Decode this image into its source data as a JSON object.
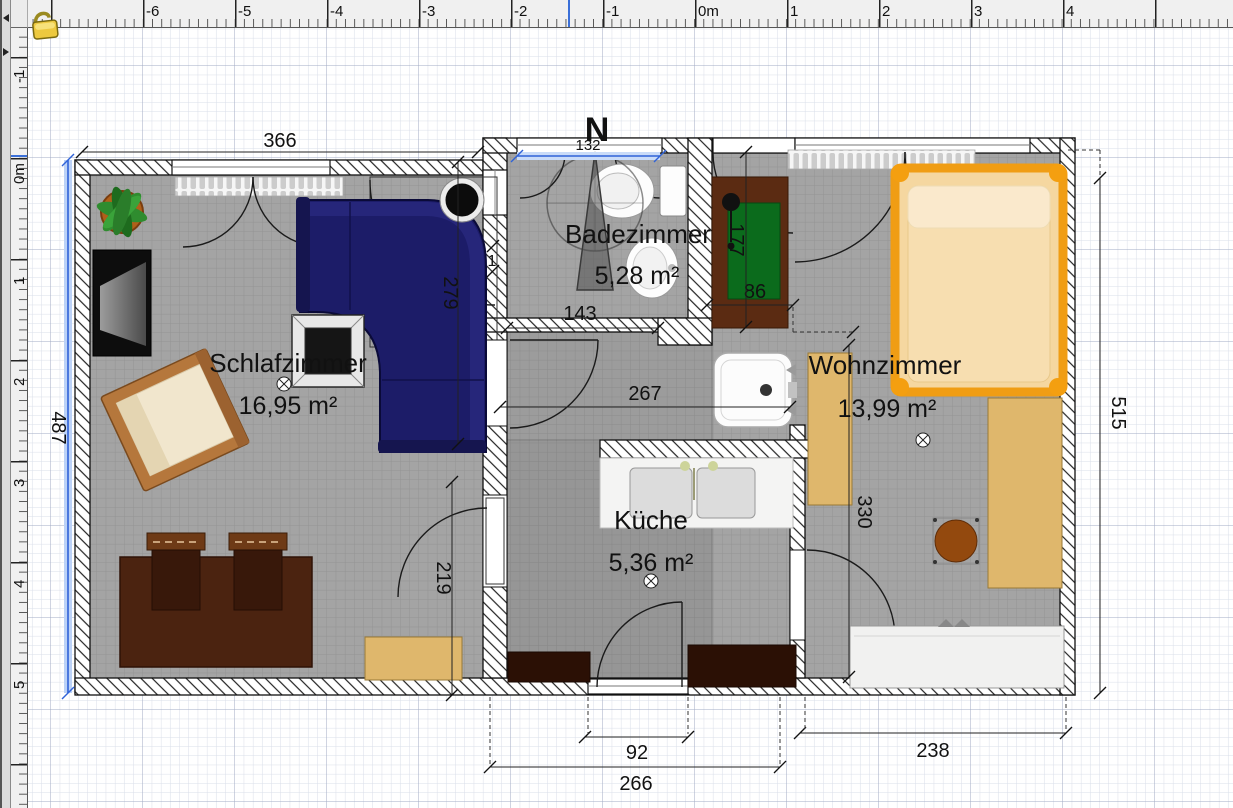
{
  "rulers": {
    "top": {
      "labels": [
        "-6",
        "-5",
        "-4",
        "-3",
        "-2",
        "-1",
        "0m",
        "1",
        "2",
        "3",
        "4"
      ]
    },
    "left": {
      "labels": [
        "-1",
        "0m",
        "1",
        "2",
        "3",
        "4",
        "5"
      ]
    },
    "cursor_color": "#3a6fd8"
  },
  "compass": {
    "label": "N"
  },
  "rooms": [
    {
      "name": "Schlafzimmer",
      "area": "16,95 m²"
    },
    {
      "name": "Badezimmer",
      "area": "5,28 m²"
    },
    {
      "name": "Küche",
      "area": "5,36 m²"
    },
    {
      "name": "Wohnzimmer",
      "area": "13,99 m²"
    }
  ],
  "dimensions": {
    "bedroom_width": "366",
    "left_height": "487",
    "bath_window": "132",
    "bath_width": "143",
    "sofa_wall": "279",
    "hall_width": "267",
    "kitchen_door": "219",
    "cabinet_width": "86",
    "cabinet_height": "177",
    "living_height": "330",
    "right_height": "515",
    "kitchen_window": "92",
    "kitchen_width": "266",
    "living_width": "238",
    "wall_gap": "1"
  },
  "colors": {
    "selection_blue": "#2f62d8",
    "room_gray": "#a4a4a4",
    "kitchen_gray": "#969696",
    "hall_gray": "#9c9c9c",
    "sofa_navy": "#1c1c68",
    "bed_frame_orange": "#f09d14",
    "bed_mattress": "#f5d7a0",
    "wood_brown": "#b5773c",
    "table_brown": "#4b2310",
    "cabinet_tan": "#dfb76c",
    "rug_green": "#0b6b1c",
    "rug_cabinet_brown": "#5b2b12",
    "counter_dark": "#2b1005",
    "round_table_brown": "#93490e",
    "white_sofa": "#f1f1f0"
  }
}
